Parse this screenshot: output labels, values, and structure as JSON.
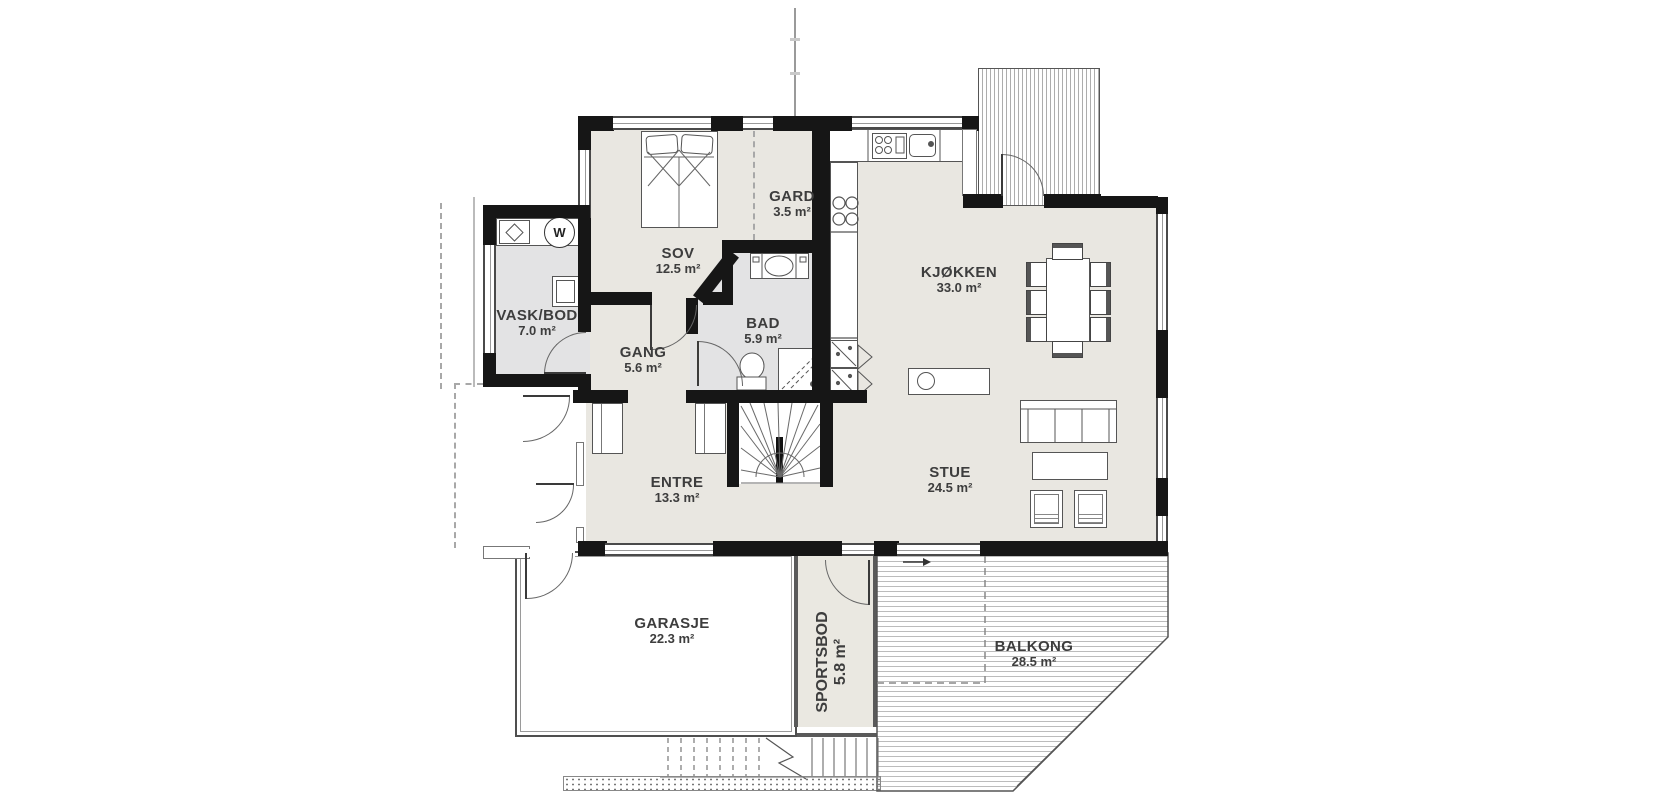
{
  "plan": {
    "type": "floor-plan",
    "unit": "m²"
  },
  "rooms": [
    {
      "id": "sov",
      "name": "SOV",
      "area": "12.5 m²"
    },
    {
      "id": "gard",
      "name": "GARD",
      "area": "3.5 m²"
    },
    {
      "id": "vask-bod",
      "name": "VASK/BOD",
      "area": "7.0 m²"
    },
    {
      "id": "gang",
      "name": "GANG",
      "area": "5.6 m²"
    },
    {
      "id": "bad",
      "name": "BAD",
      "area": "5.9 m²"
    },
    {
      "id": "kjokken",
      "name": "KJØKKEN",
      "area": "33.0 m²"
    },
    {
      "id": "entre",
      "name": "ENTRE",
      "area": "13.3 m²"
    },
    {
      "id": "stue",
      "name": "STUE",
      "area": "24.5 m²"
    },
    {
      "id": "garasje",
      "name": "GARASJE",
      "area": "22.3 m²"
    },
    {
      "id": "sportsbod",
      "name": "SPORTSBOD",
      "area": "5.8 m²"
    },
    {
      "id": "balkong",
      "name": "BALKONG",
      "area": "28.5 m²"
    }
  ],
  "icons": {
    "washer_letter": "W"
  },
  "colors": {
    "wall": "#161616",
    "floor_main": "#e9e7e1",
    "floor_wet": "#e3e3e4",
    "floor_storage": "#eae8e1",
    "deck_line": "#bcbcbc",
    "outline": "#555555"
  }
}
